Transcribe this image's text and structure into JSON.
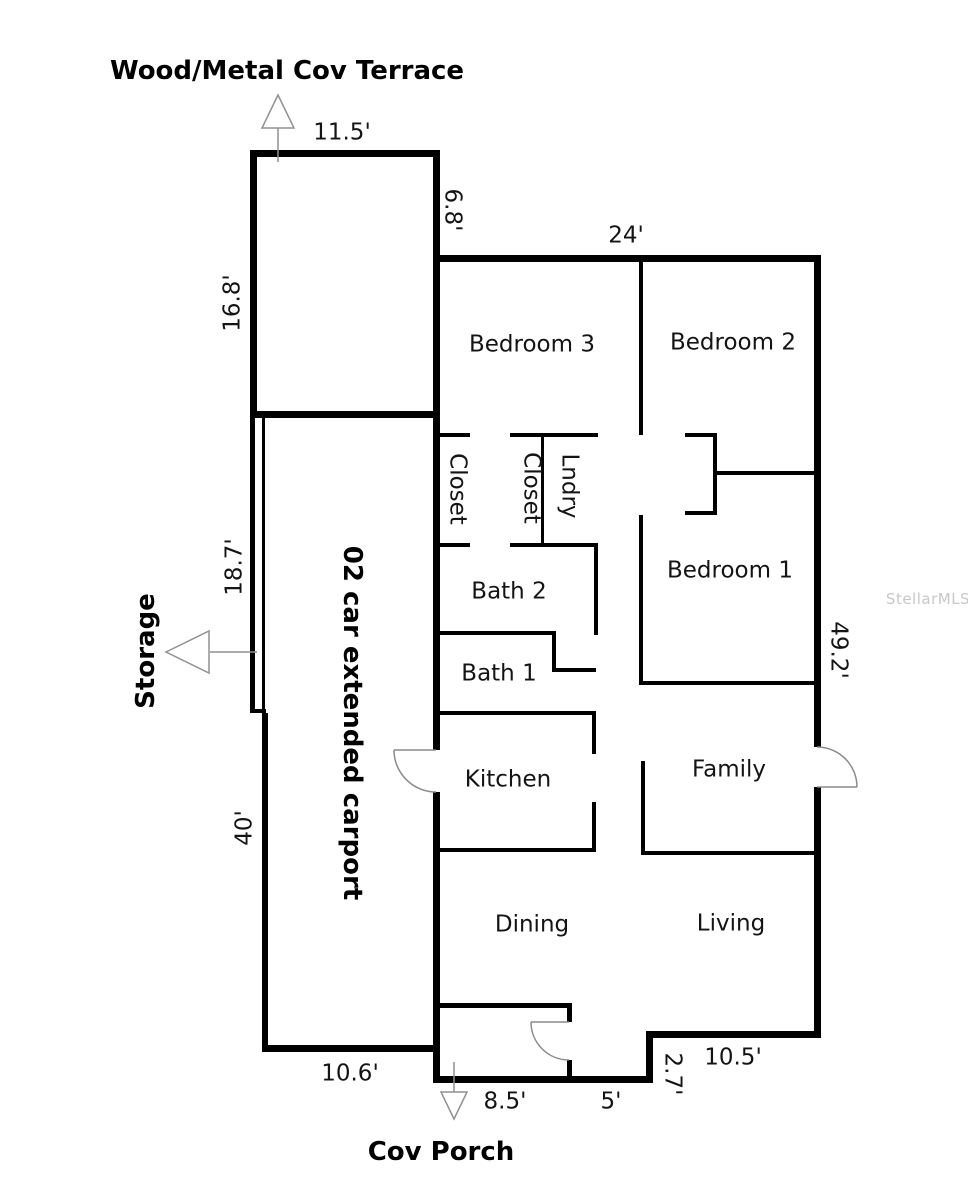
{
  "features": {
    "terrace": "Wood/Metal Cov Terrace",
    "storage": "Storage",
    "carport": "02 car extended carport",
    "porch": "Cov Porch"
  },
  "rooms": {
    "bedroom3": "Bedroom 3",
    "bedroom2": "Bedroom 2",
    "bedroom1": "Bedroom 1",
    "closet1": "Closet",
    "closet2": "Closet",
    "laundry": "Lndry",
    "bath2": "Bath 2",
    "bath1": "Bath 1",
    "kitchen": "Kitchen",
    "family": "Family",
    "dining": "Dining",
    "living": "Living"
  },
  "dimensions": {
    "terrace_width": "11.5'",
    "terrace_height": "16.8'",
    "terrace_right_side": "6.8'",
    "house_top_width": "24'",
    "storage_strip_length": "18.7'",
    "carport_length": "40'",
    "house_right_height": "49.2'",
    "carport_bottom_width": "10.6'",
    "porch_width": "8.5'",
    "entry_width": "5'",
    "step_depth": "2.7'",
    "bottom_right_width": "10.5'"
  },
  "watermark": "StellarMLS",
  "colors": {
    "wall": "#000000",
    "arrow": "#919191",
    "door_arc": "#8a8a8a",
    "watermark": "#c8c8c8",
    "background": "#ffffff"
  }
}
